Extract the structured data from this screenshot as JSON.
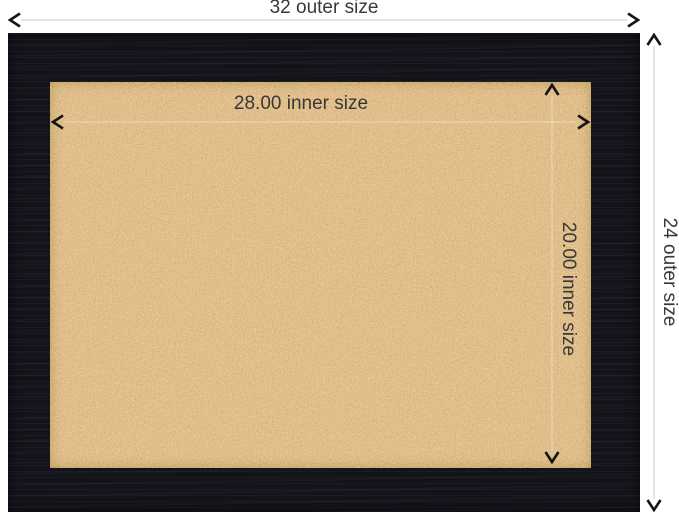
{
  "image_type": "framed cork board dimension diagram",
  "dimensions": {
    "outer_width": {
      "label": "32 outer size"
    },
    "outer_height": {
      "label": "24 outer size"
    },
    "inner_width": {
      "label": "28.00 inner size"
    },
    "inner_height": {
      "label": "20.00 inner size"
    }
  },
  "colors": {
    "background": "#ffffff",
    "frame": "#13131a",
    "cork": "#cf9a63",
    "dimension_text": "#383838",
    "outer_dimension_line": "#c8c8c8",
    "inner_dimension_line": "rgba(255,255,255,0.42)",
    "arrowhead": "#141414"
  }
}
